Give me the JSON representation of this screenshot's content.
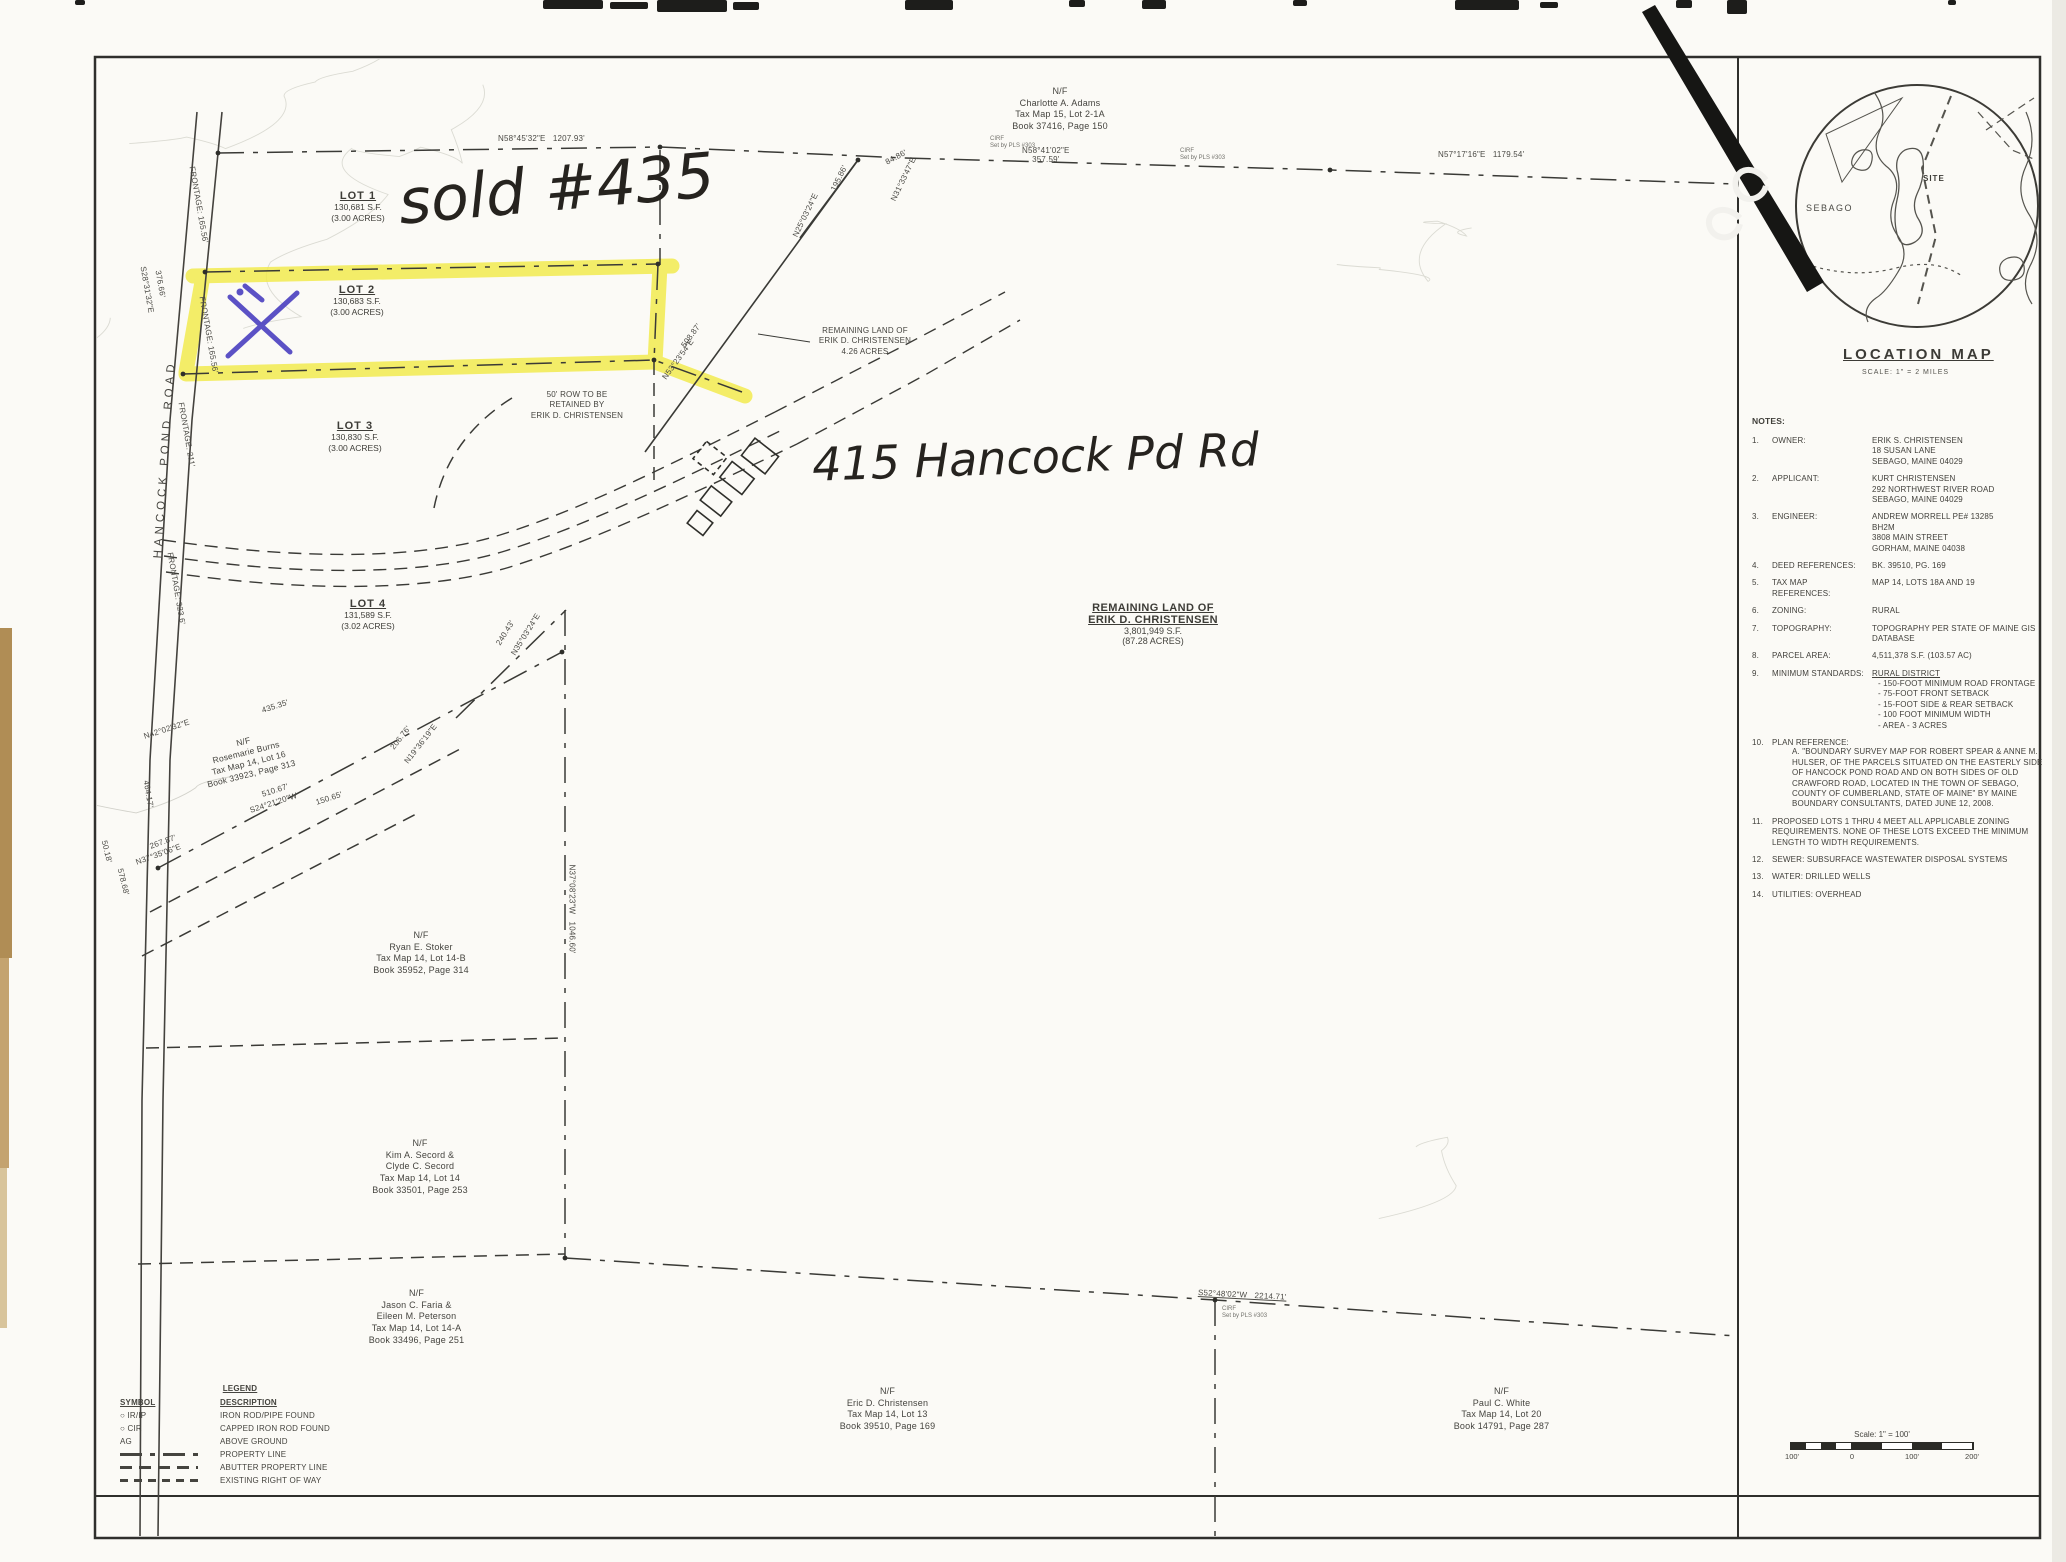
{
  "colors": {
    "paper": "#fbfaf6",
    "ink": "#3a3a35",
    "highlight": "#f2ea45",
    "pen_blue": "#4a3fc0",
    "scan_tan": "#b08d55"
  },
  "handwriting": {
    "sold": "sold #435",
    "address": "415 Hancock Pd Rd"
  },
  "road": {
    "name": "HANCOCK POND ROAD"
  },
  "lots": [
    {
      "name": "LOT 1",
      "sf": "130,681 S.F.",
      "acres": "(3.00 ACRES)"
    },
    {
      "name": "LOT 2",
      "sf": "130,683 S.F.",
      "acres": "(3.00 ACRES)"
    },
    {
      "name": "LOT 3",
      "sf": "130,830 S.F.",
      "acres": "(3.00 ACRES)"
    },
    {
      "name": "LOT 4",
      "sf": "131,589 S.F.",
      "acres": "(3.02 ACRES)"
    }
  ],
  "parcels": {
    "remaining_small": "REMAINING LAND OF\nERIK D. CHRISTENSEN\n4.26 ACRES",
    "row_note": "50' ROW TO BE\nRETAINED BY\nERIK D. CHRISTENSEN",
    "remaining_large_title": "REMAINING LAND OF\nERIK D. CHRISTENSEN",
    "remaining_large_area": "3,801,949 S.F.\n(87.28 ACRES)"
  },
  "abutters": [
    {
      "nf": "N/F",
      "lines": "Charlotte A. Adams\nTax Map 15, Lot 2-1A\nBook 37416, Page 150"
    },
    {
      "nf": "N/F",
      "lines": "Rosemarie Burns\nTax Map 14, Lot 16\nBook 33923, Page 313"
    },
    {
      "nf": "N/F",
      "lines": "Ryan E. Stoker\nTax Map 14, Lot 14-B\nBook 35952, Page 314"
    },
    {
      "nf": "N/F",
      "lines": "Kim A. Secord &\nClyde C. Secord\nTax Map 14, Lot 14\nBook 33501, Page 253"
    },
    {
      "nf": "N/F",
      "lines": "Jason C. Faria &\nEileen M. Peterson\nTax Map 14, Lot 14-A\nBook 33496, Page 251"
    },
    {
      "nf": "N/F",
      "lines": "Eric D. Christensen\nTax Map 14, Lot 13\nBook 39510, Page 169"
    },
    {
      "nf": "N/F",
      "lines": "Paul C. White\nTax Map 14, Lot 20\nBook 14791, Page 287"
    }
  ],
  "bearings": [
    {
      "text": "N58°45'32\"E   1207.93'"
    },
    {
      "text": "N58°41'02\"E\n357.59'"
    },
    {
      "text": "N57°17'16\"E   1179.54'"
    },
    {
      "text": "84.86'"
    },
    {
      "text": "N31°33'47\"E"
    },
    {
      "text": "195.86'"
    },
    {
      "text": "N25°03'24\"E"
    },
    {
      "text": "S28°31'32\"E"
    },
    {
      "text": "376.66'"
    },
    {
      "text": "FRONTAGE: 165.56'"
    },
    {
      "text": "FRONTAGE: 165.56'"
    },
    {
      "text": "FRONTAGE: 211'"
    },
    {
      "text": "FRONTAGE: 323.6'"
    },
    {
      "text": "508.87'"
    },
    {
      "text": "N53°23'54\"E"
    },
    {
      "text": "240.43'"
    },
    {
      "text": "N35°03'24\"E"
    },
    {
      "text": "206.76'"
    },
    {
      "text": "N19°36'19\"E"
    },
    {
      "text": "435.35'"
    },
    {
      "text": "N42°02'32\"E"
    },
    {
      "text": "510.67'"
    },
    {
      "text": "S24°21'20\"W"
    },
    {
      "text": "150.65'"
    },
    {
      "text": "267.87'"
    },
    {
      "text": "N37°35'06\"E"
    },
    {
      "text": "50.18'"
    },
    {
      "text": "578.68'"
    },
    {
      "text": "N37°08'23\"W   1046.60'"
    },
    {
      "text": "S52°48'02\"W   2214.71'"
    },
    {
      "text": "464.17'"
    }
  ],
  "marker_note": "CIRF\nSet by PLS #303",
  "location_map": {
    "title": "LOCATION MAP",
    "scale": "SCALE: 1\" = 2 MILES",
    "town": "SEBAGO",
    "site": "SITE"
  },
  "notes": {
    "heading": "NOTES:",
    "items": [
      {
        "num": "1.",
        "label": "OWNER:",
        "value": "ERIK S. CHRISTENSEN\n18 SUSAN LANE\nSEBAGO, MAINE 04029"
      },
      {
        "num": "2.",
        "label": "APPLICANT:",
        "value": "KURT CHRISTENSEN\n292 NORTHWEST RIVER ROAD\nSEBAGO, MAINE 04029"
      },
      {
        "num": "3.",
        "label": "ENGINEER:",
        "value": "ANDREW MORRELL PE# 13285\nBH2M\n3808 MAIN STREET\nGORHAM, MAINE 04038"
      },
      {
        "num": "4.",
        "label": "DEED REFERENCES:",
        "value": "BK. 39510, PG. 169"
      },
      {
        "num": "5.",
        "label": "TAX MAP REFERENCES:",
        "value": "MAP 14, LOTS 18A AND 19"
      },
      {
        "num": "6.",
        "label": "ZONING:",
        "value": "RURAL"
      },
      {
        "num": "7.",
        "label": "TOPOGRAPHY:",
        "value": "TOPOGRAPHY PER STATE OF MAINE GIS\nDATABASE"
      },
      {
        "num": "8.",
        "label": "PARCEL AREA:",
        "value": "4,511,378 S.F. (103.57 AC)"
      },
      {
        "num": "9.",
        "label": "MINIMUM STANDARDS:",
        "heading": "RURAL DISTRICT",
        "value": "- 150-FOOT MINIMUM ROAD FRONTAGE\n- 75-FOOT FRONT SETBACK\n- 15-FOOT SIDE & REAR SETBACK\n- 100 FOOT MINIMUM WIDTH\n- AREA - 3 ACRES"
      },
      {
        "num": "10.",
        "label": "PLAN REFERENCE:",
        "value": "A.   \"BOUNDARY SURVEY MAP FOR ROBERT SPEAR & ANNE M. HULSER, OF THE PARCELS SITUATED ON THE EASTERLY SIDE OF HANCOCK POND ROAD AND ON BOTH SIDES OF OLD CRAWFORD ROAD, LOCATED IN THE TOWN OF SEBAGO, COUNTY OF CUMBERLAND, STATE OF MAINE\" BY MAINE BOUNDARY CONSULTANTS, DATED JUNE 12, 2008."
      },
      {
        "num": "11.",
        "text": "PROPOSED LOTS 1 THRU 4 MEET ALL APPLICABLE ZONING REQUIREMENTS. NONE OF THESE LOTS EXCEED THE MINIMUM LENGTH TO WIDTH REQUIREMENTS."
      },
      {
        "num": "12.",
        "text": "SEWER: SUBSURFACE WASTEWATER DISPOSAL SYSTEMS"
      },
      {
        "num": "13.",
        "text": "WATER: DRILLED WELLS"
      },
      {
        "num": "14.",
        "text": "UTILITIES: OVERHEAD"
      }
    ]
  },
  "legend": {
    "title": "LEGEND",
    "symbol_header": "SYMBOL",
    "description_header": "DESCRIPTION",
    "rows": [
      {
        "sym": "○ IR/IP",
        "desc": "IRON ROD/PIPE FOUND"
      },
      {
        "sym": "○ CIR",
        "desc": "CAPPED IRON ROD FOUND"
      },
      {
        "sym": "AG",
        "desc": "ABOVE GROUND"
      },
      {
        "sym": "",
        "desc": "PROPERTY LINE"
      },
      {
        "sym": "",
        "desc": "ABUTTER PROPERTY LINE"
      },
      {
        "sym": "",
        "desc": "EXISTING RIGHT OF WAY"
      }
    ]
  },
  "scale_bar": {
    "label": "Scale: 1\" = 100'",
    "ticks": [
      "100'",
      "0",
      "100'",
      "200'"
    ]
  }
}
